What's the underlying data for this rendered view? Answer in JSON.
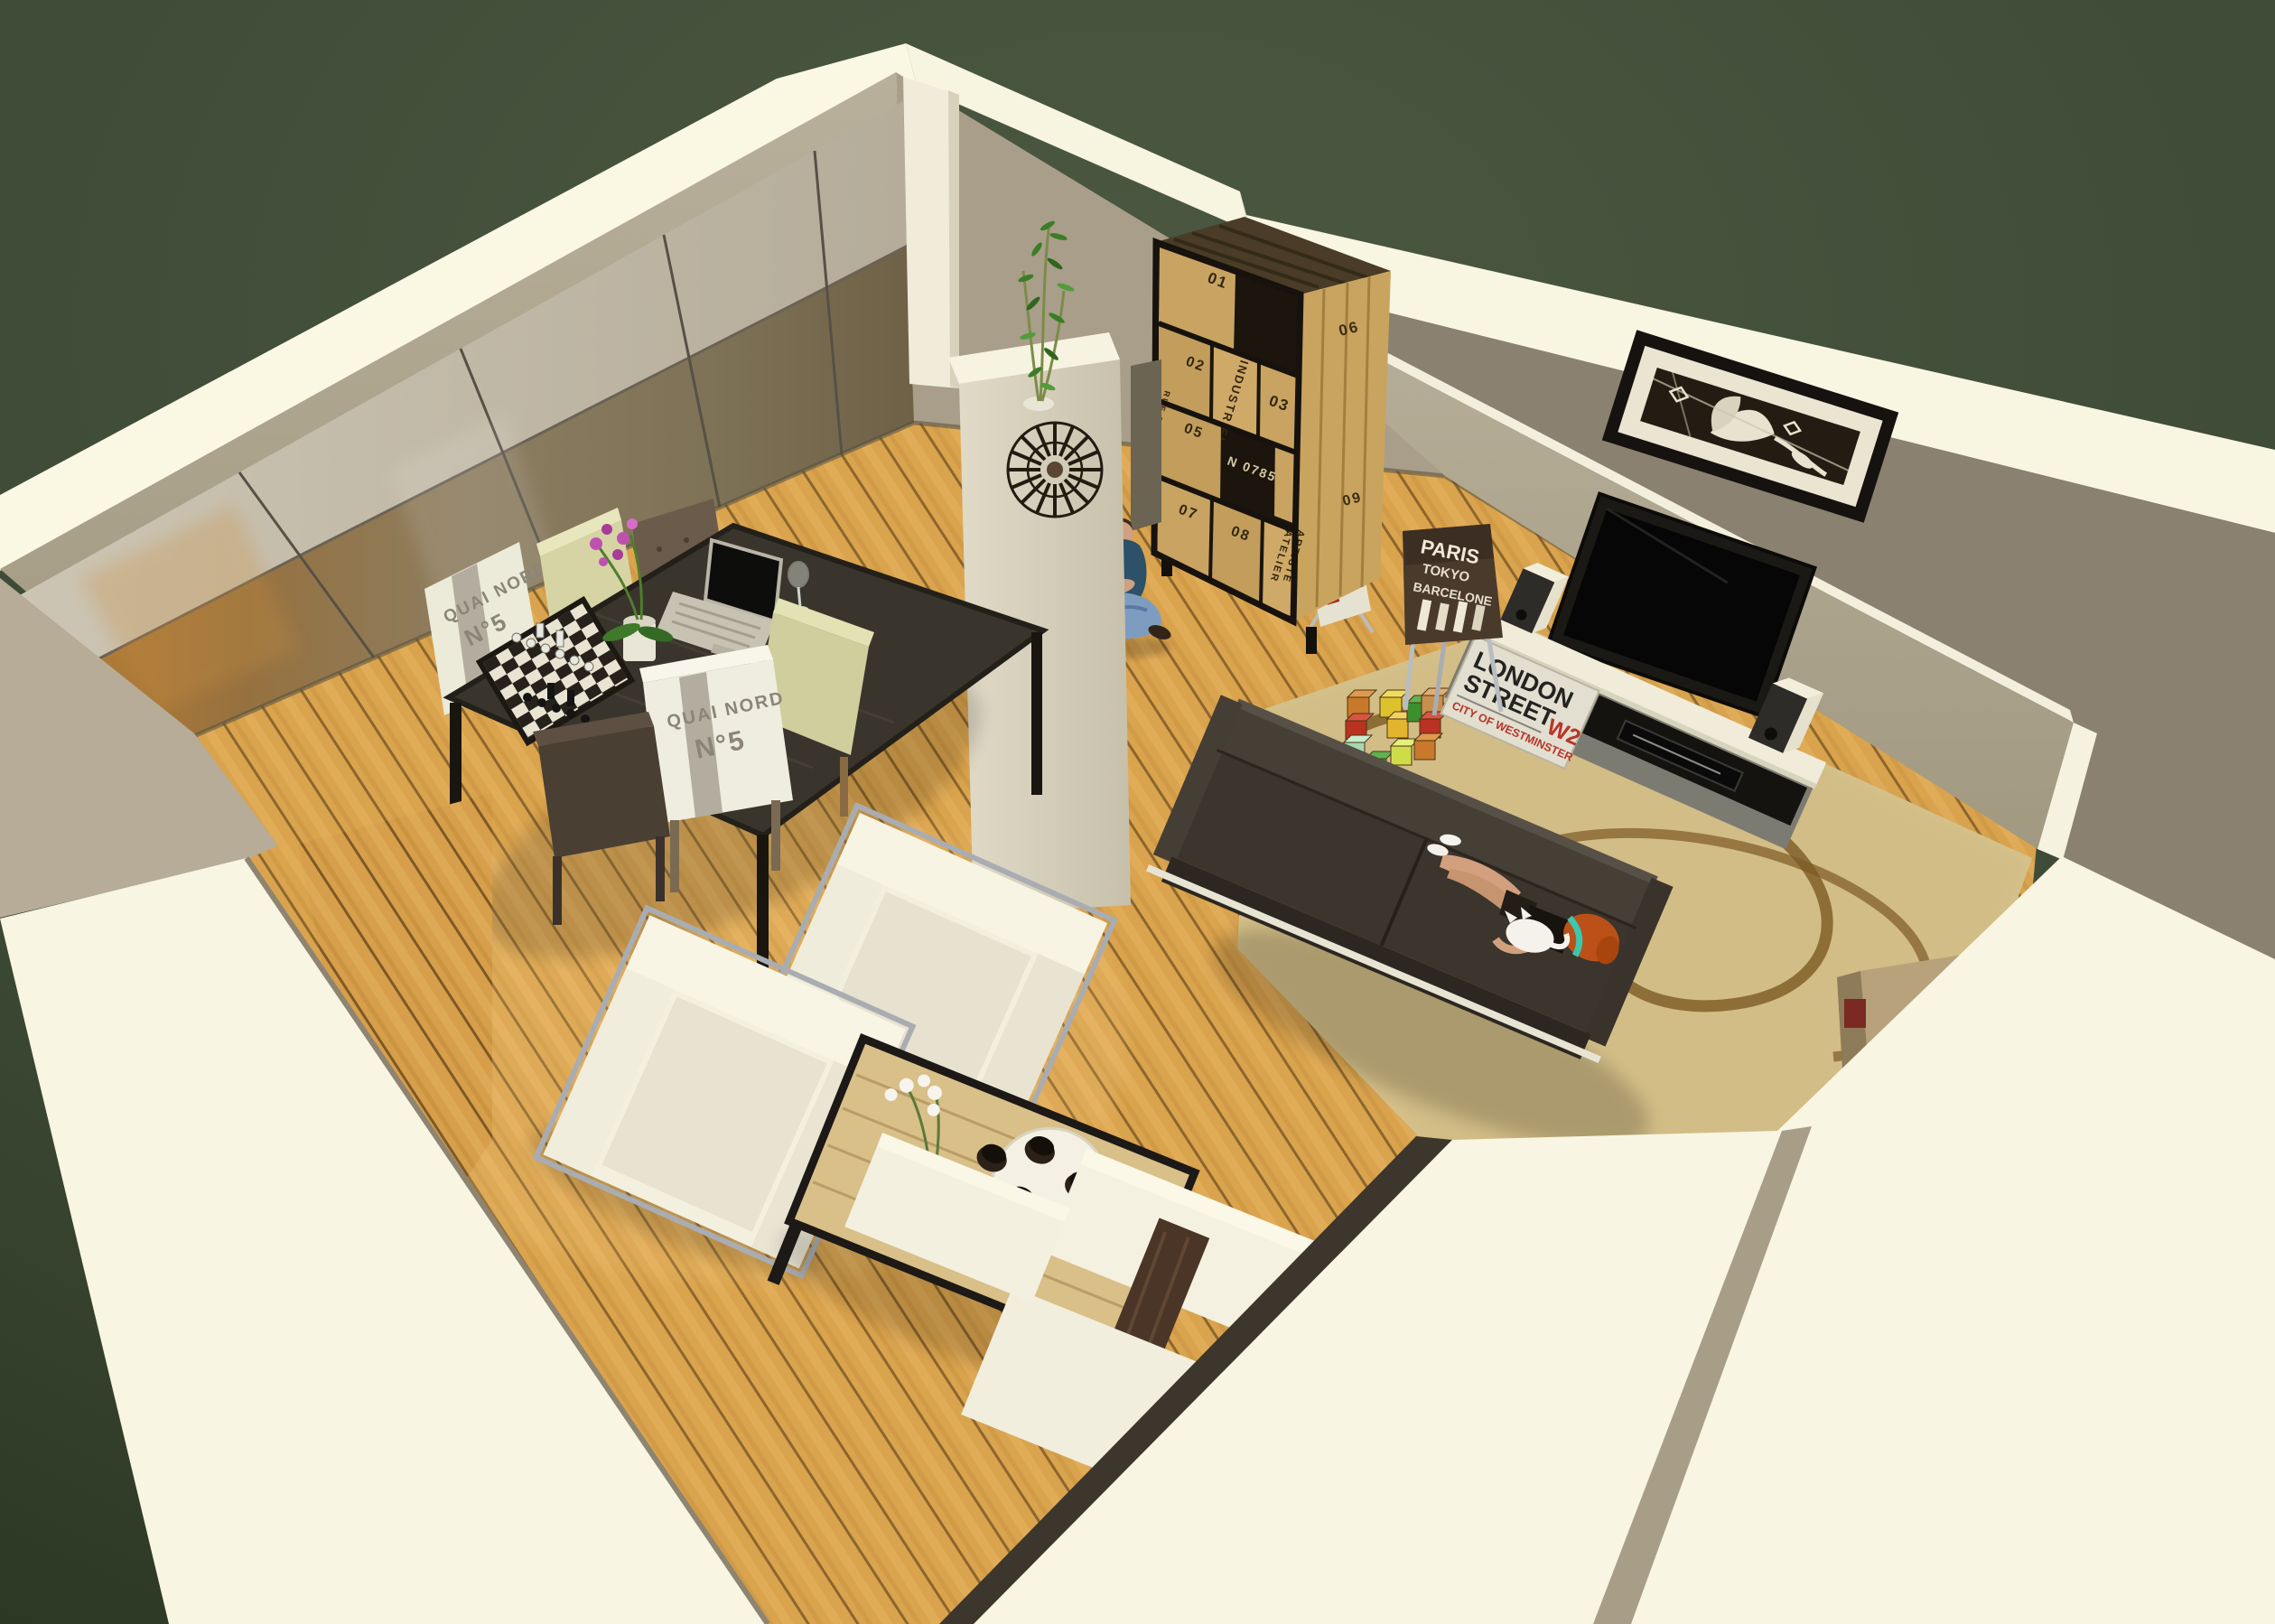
{
  "scene": {
    "type": "3d-interior-render",
    "description": "Bird's-eye cutaway render of an open-plan living room: oak plank floor, mirrored wardrobe wall, industrial crate bookshelf, pillar with sunburst clock, TV wall with framed art, dark sofa with woman and cat, toy blocks on a sand rug, dining table with chessboard and laptop, two white cube armchairs, wood coffee table with tray of cups, white sectional, bright wall tops over a dark green backdrop"
  },
  "palette": {
    "backdrop_green": "#45523c",
    "backdrop_green_dark": "#2a3526",
    "wall_top_bright": "#faf7e3",
    "wall_greige": "#b0a792",
    "wall_greige_dark": "#8a8170",
    "floor_oak": "#d79f4b",
    "floor_seam": "#6d4c1d",
    "rug_sand": "#d8c48e",
    "rug_swirl_brown": "#7c5a23",
    "sofa_charcoal": "#3b352d",
    "white_furniture": "#f3f0df",
    "chrome": "#a9adb2",
    "shelf_wood": "#c8a362",
    "shelf_frame_black": "#17120d",
    "tv_black": "#0a0a09",
    "sign_red": "#b5362a",
    "orchid_pink": "#c050b0",
    "bamboo_green": "#3b7d27",
    "hair_orange": "#bb5118",
    "headband_teal": "#3cc7ae",
    "jeans_blue": "#7d9cc0"
  },
  "texts": {
    "bookshelf": {
      "n01": "01",
      "n02": "02",
      "n03": "03",
      "n05": "05",
      "n06": "06",
      "n07": "07",
      "n08": "08",
      "n09": "09",
      "serial": "N 0785",
      "v_industriel": "INDUSTRIEL",
      "v_rue": "RUE DE L'INDUSTRIE",
      "v_atelier": "ATELIER",
      "v_artiste": "ARTISTE"
    },
    "street_sign": {
      "l1": "LONDON",
      "l2": "STREET",
      "w2": "W2",
      "l3": "CITY OF WESTMINSTER"
    },
    "chair_print": {
      "l1": "PARIS",
      "l2": "TOKYO",
      "l3": "BARCELONE"
    },
    "seat_cover_top": {
      "l1": "QUAI NORD",
      "l2": "N°5"
    },
    "seat_cover_bottom": {
      "l1": "QUAI NORD",
      "l2": "N°5"
    }
  },
  "objects": [
    "mirrored-wardrobe-wall",
    "bamboo-plant",
    "industrial-bookshelf",
    "white-pillar",
    "sunburst-clock",
    "man-sitting",
    "framed-wall-art",
    "flat-screen-tv",
    "tv-stand-london-sign",
    "speakers",
    "dvd-player",
    "paris-print-chair",
    "magazine-rack",
    "dark-sofa",
    "woman-lying",
    "white-cat",
    "toy-blocks",
    "sand-rug",
    "dining-table",
    "chessboard",
    "laptop",
    "orchid-pot",
    "wine-glass",
    "dining-chairs",
    "white-cube-armchairs",
    "coffee-table",
    "cup-tray",
    "white-orchid-vase",
    "white-sectional",
    "walnut-panel",
    "corridor-cabinet",
    "cutaway-wall-tops"
  ]
}
